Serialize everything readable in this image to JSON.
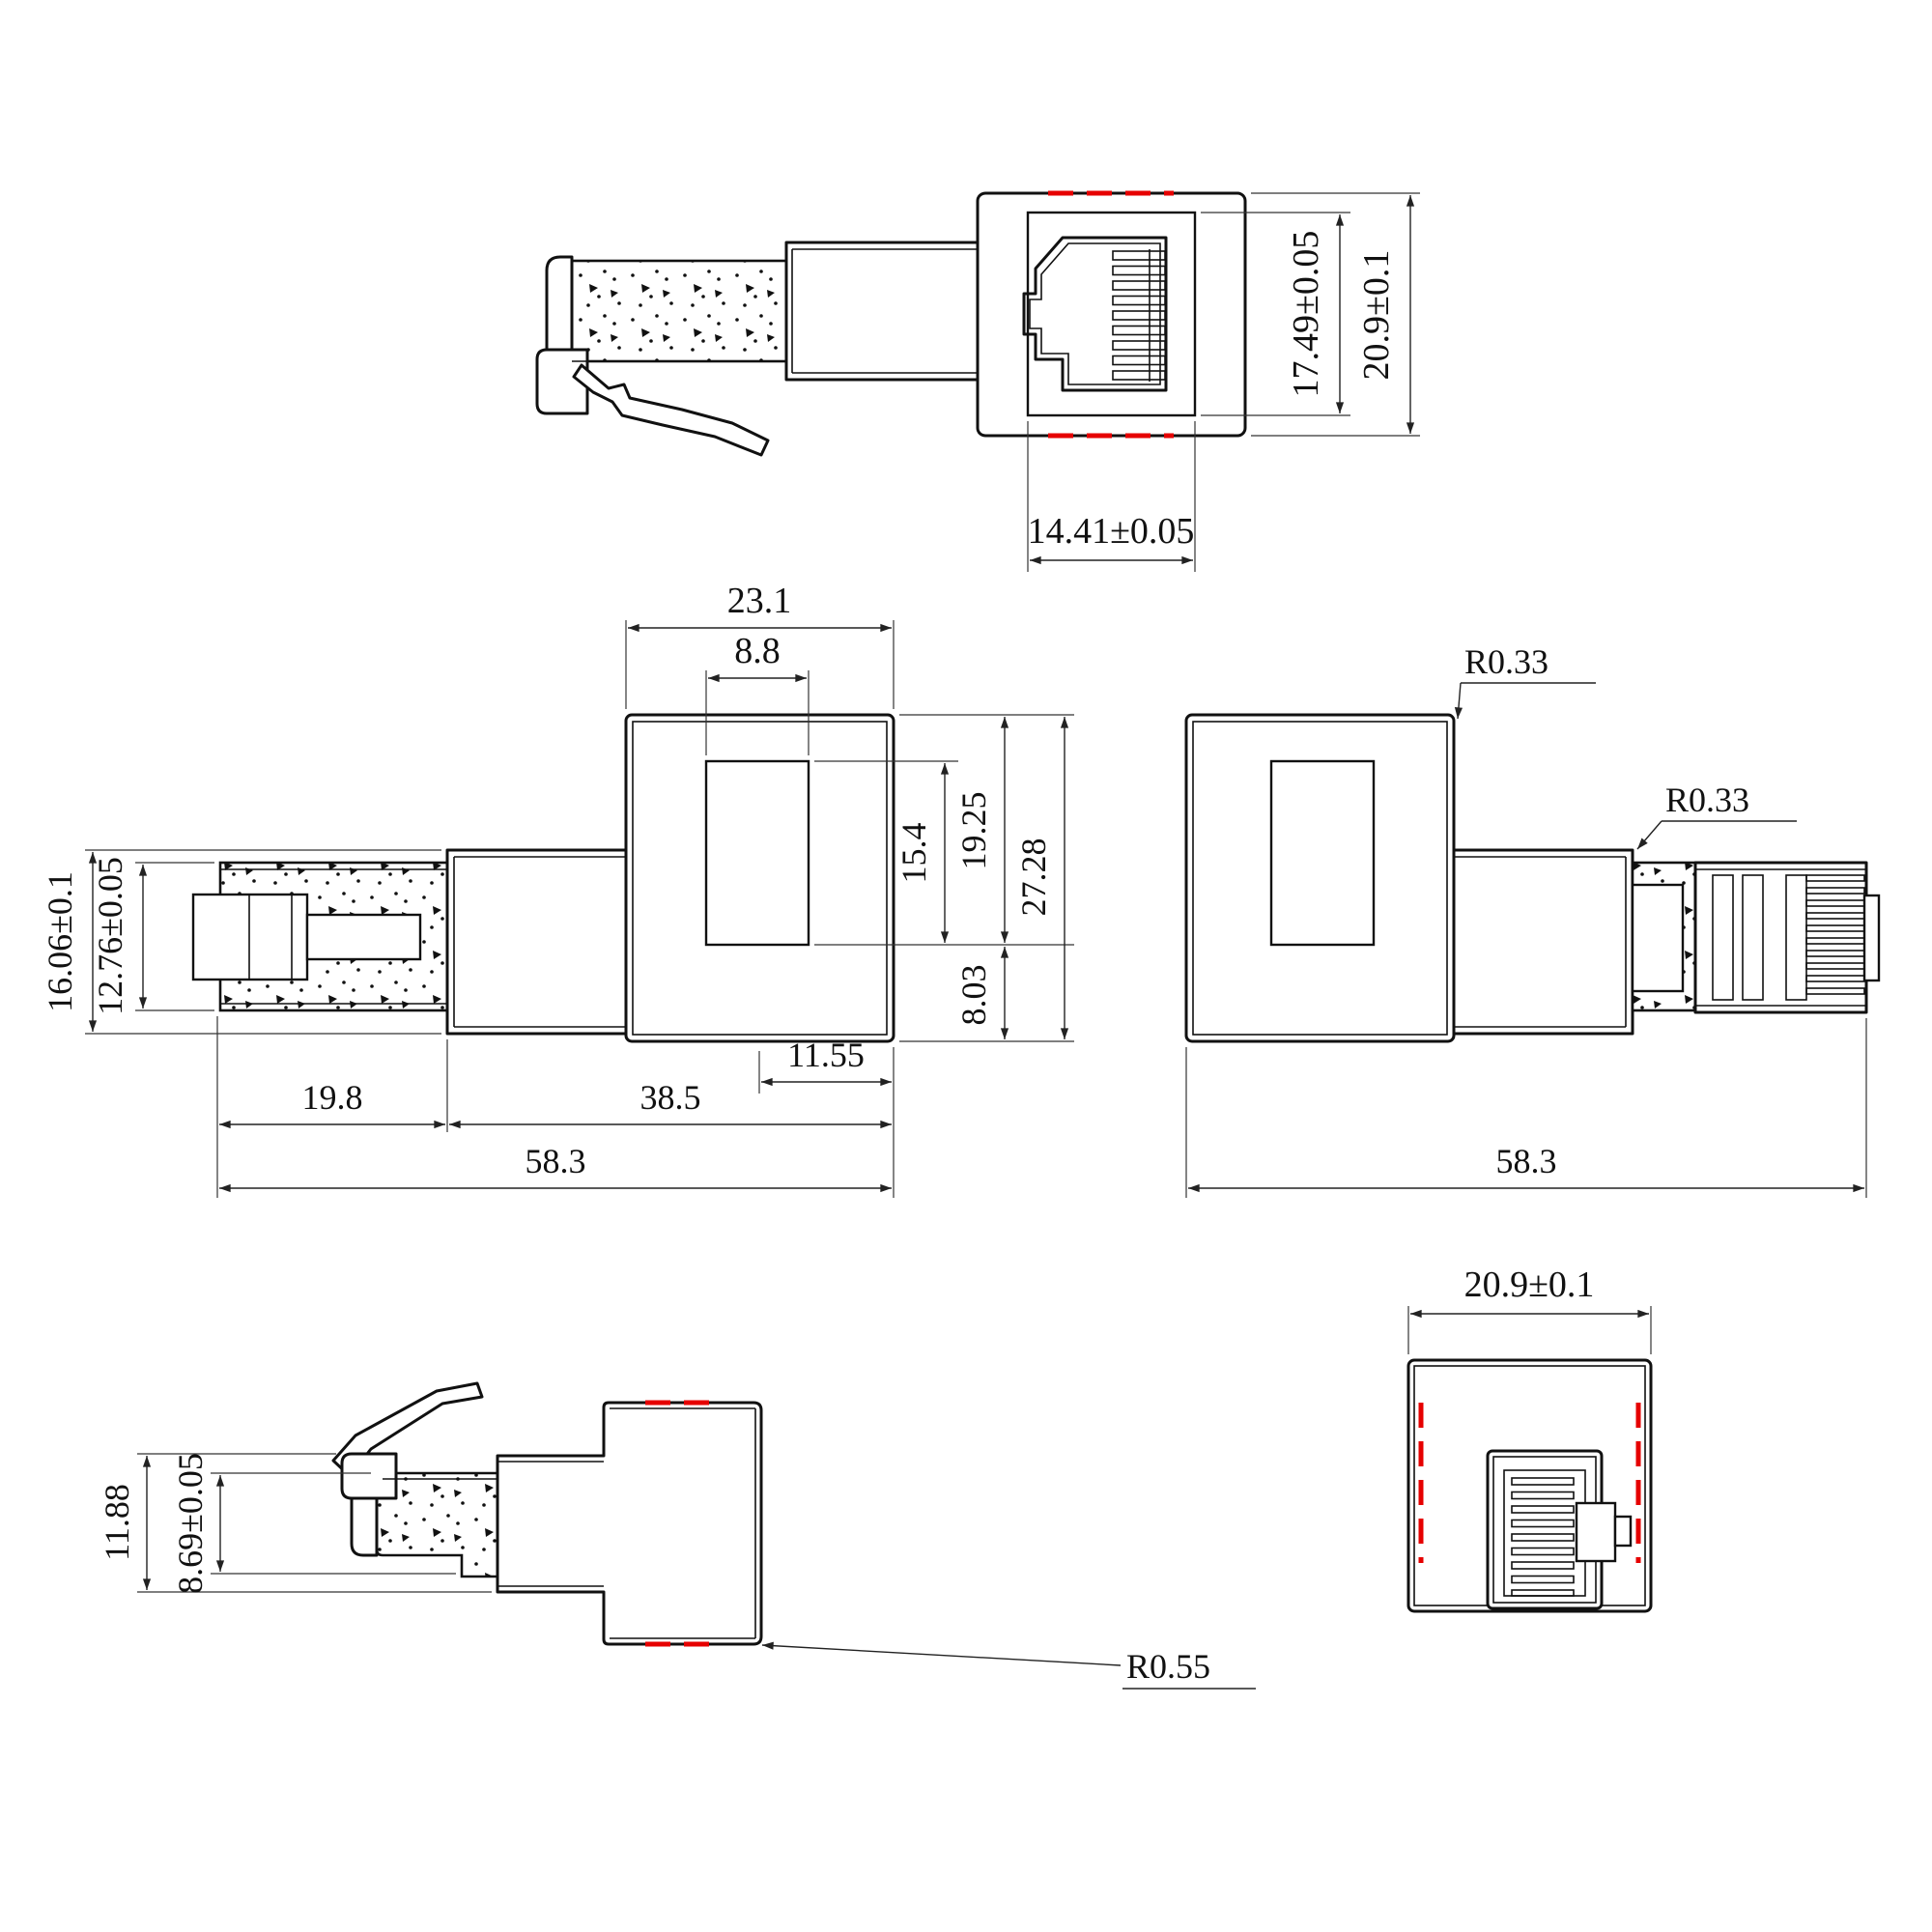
{
  "drawing_type": "engineering-dimension-drawing",
  "part": "RJ45 coupler adapter with modular plug",
  "views": {
    "top_view": {
      "dim_socket_height": "17.49±0.05",
      "dim_body_height": "20.9±0.1",
      "dim_socket_width": "14.41±0.05"
    },
    "side_view_left": {
      "dim_body_width": "23.1",
      "dim_port_width": "8.8",
      "dim_sleeve_height": "16.06±0.1",
      "dim_plug_height": "12.76±0.05",
      "dim_port_height": "15.4",
      "dim_top_to_port": "19.25",
      "dim_body_height": "27.28",
      "dim_port_to_bottom": "8.03",
      "dim_body_offset": "11.55",
      "dim_plug_length": "19.8",
      "dim_body_length": "38.5",
      "dim_total_length": "58.3"
    },
    "side_view_right": {
      "radius_body_corner": "R0.33",
      "radius_sleeve_corner": "R0.33",
      "dim_total_length": "58.3"
    },
    "bottom_view": {
      "dim_sleeve_height": "11.88",
      "dim_plug_height": "8.69±0.05",
      "radius_corner": "R0.55"
    },
    "rear_view": {
      "dim_body_width": "20.9±0.1"
    }
  },
  "colors": {
    "line": "#111111",
    "highlight_red": "#e60000",
    "background": "#ffffff"
  }
}
